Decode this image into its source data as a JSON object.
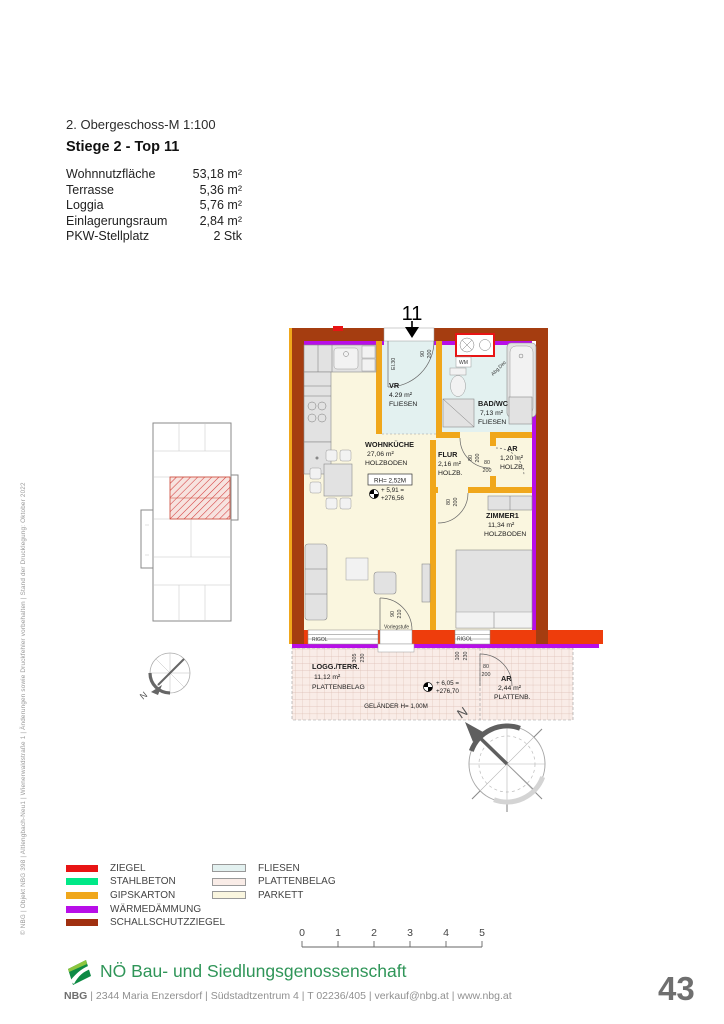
{
  "page": {
    "number": "43"
  },
  "side_note": "© NBG | Objekt NBG 398 | Altlengbach-Neu1 | Wienerwaldstraße 1 | Änderungen sowie Druckfehler vorbehalten | Stand der Drucklegung: Oktober 2022",
  "header": {
    "plan_title": "2. Obergeschoss-M 1:100",
    "unit_title": "Stiege 2 - Top 11",
    "specs": [
      {
        "label": "Wohnnutzfläche",
        "value": "53,18 m²"
      },
      {
        "label": "Terrasse",
        "value": "5,36 m²"
      },
      {
        "label": "Loggia",
        "value": "5,76 m²"
      },
      {
        "label": "Einlagerungsraum",
        "value": "2,84 m²"
      },
      {
        "label": "PKW-Stellplatz",
        "value": "2 Stk"
      }
    ]
  },
  "floorplan": {
    "unit_number": "11",
    "rooms": [
      {
        "name": "VR",
        "area": "4.29 m²",
        "floor": "FLIESEN"
      },
      {
        "name": "BAD/WC",
        "area": "7,13 m²",
        "floor": "FLIESEN"
      },
      {
        "name": "WOHNKÜCHE",
        "area": "27,06 m²",
        "floor": "HOLZBODEN"
      },
      {
        "name": "FLUR",
        "area": "2,16 m²",
        "floor": "HOLZB."
      },
      {
        "name": "AR",
        "area": "1,20 m²",
        "floor": "HOLZB."
      },
      {
        "name": "ZIMMER1",
        "area": "11,34 m²",
        "floor": "HOLZBODEN"
      },
      {
        "name": "LOGG./TERR.",
        "area": "11,12 m²",
        "floor": "PLATTENBELAG"
      },
      {
        "name": "AR",
        "area": "2,44 m²",
        "floor": "PLATTENB."
      }
    ],
    "labels": {
      "rh": "RH= 2,52M",
      "level_main_a": "+ 5,91 =",
      "level_main_b": "+276,56",
      "level_loggia_a": "+ 6,05 =",
      "level_loggia_b": "+276,70",
      "gelaender": "GELÄNDER H= 1,00M",
      "vorlegstufe": "Vorlegstufe",
      "abgedeckte_decke": "Abg.Dec",
      "rigol": "RIGOL",
      "wm": "WM",
      "el": "El.30",
      "north": "N"
    },
    "dims": {
      "d80": "80",
      "d90": "90",
      "d100": "100",
      "d200": "200",
      "d210": "210",
      "d230": "230",
      "d305": "305"
    }
  },
  "legend": {
    "materials": [
      {
        "label": "ZIEGEL",
        "color": "#e81414"
      },
      {
        "label": "STAHLBETON",
        "color": "#00e887"
      },
      {
        "label": "GIPSKARTON",
        "color": "#f0a71b"
      },
      {
        "label": "WÄRMEDÄMMUNG",
        "color": "#b80ee8"
      },
      {
        "label": "SCHALLSCHUTZZIEGEL",
        "color": "#a03010"
      }
    ],
    "surfaces": [
      {
        "label": "FLIESEN",
        "color": "#e3f1f0"
      },
      {
        "label": "PLATTENBELAG",
        "color": "#f9ece7"
      },
      {
        "label": "PARKETT",
        "color": "#faf6df"
      }
    ]
  },
  "scalebar": {
    "ticks": [
      "0",
      "1",
      "2",
      "3",
      "4",
      "5"
    ]
  },
  "footer": {
    "brand": "NBG",
    "company": "NÖ Bau- und Siedlungsgenossenschaft",
    "contact": " | 2344 Maria Enzersdorf | Südstadtzentrum 4 | T 02236/405 |  verkauf@nbg.at | www.nbg.at"
  }
}
